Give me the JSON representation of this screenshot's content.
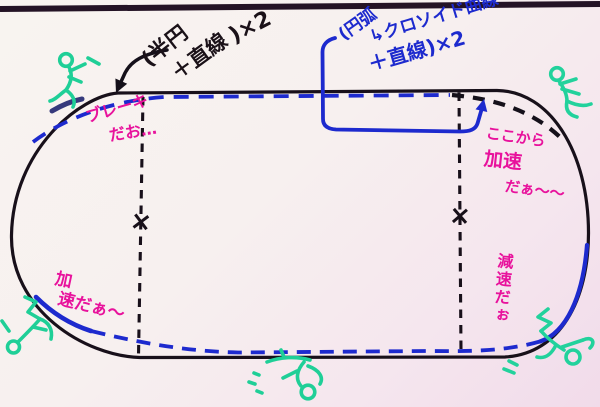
{
  "scene_title": "whiteboard-oval-track-sketch",
  "colors": {
    "marker_black": "#1a1118",
    "marker_blue": "#1d2ace",
    "marker_pink": "#e8129c",
    "marker_green": "#1fcf97",
    "frame": "#241325",
    "background": "#f7f1ee",
    "background_tint": "#f1dbea"
  },
  "annotations": {
    "straight_note": {
      "part1": "(半円",
      "part2": "＋直線",
      "part3": ")×2"
    },
    "clothoid_note": {
      "part1": "(円弧",
      "part2": "↳クロソイド曲線",
      "part3": "＋直線)×2"
    },
    "brake_note": {
      "line1": "ブレーキ",
      "line2": "だお…"
    },
    "accel_here_note": {
      "line1": "ここから",
      "line2": "加速",
      "line3": "だぁ〜〜"
    },
    "accel_note": {
      "line1": "加",
      "line2": "速だぁ〜"
    },
    "decel_note": {
      "text": "減速だぉ"
    }
  },
  "marks": {
    "x_left": "×",
    "x_right": "×"
  },
  "figures": [
    "runner-top-left",
    "runner-top-right",
    "tumbler-bottom-left",
    "tumbler-bottom-center",
    "tumbler-bottom-right"
  ]
}
